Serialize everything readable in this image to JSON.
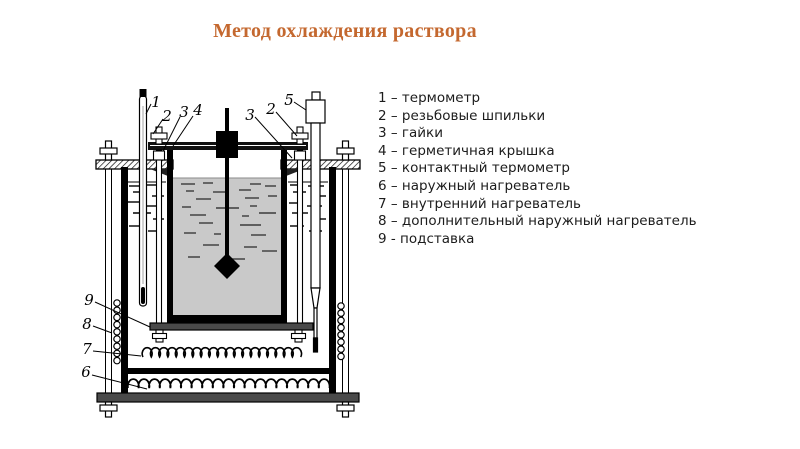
{
  "title": "Метод охлаждения раствора",
  "colors": {
    "title_accent": "#c4682f",
    "line": "#000000",
    "liquid": "#c9c9c9",
    "metal": "#4a4a4a"
  },
  "legend": {
    "items": [
      "1 – термометр",
      "2 – резьбовые шпильки",
      "3 – гайки",
      "4 – герметичная крышка",
      "5 – контактный термометр",
      "6 – наружный нагреватель",
      "7 – внутренний нагреватель",
      "8 – дополнительный наружный нагреватель",
      "9 - подставка"
    ]
  },
  "diagram": {
    "callouts": {
      "thermometer": "1",
      "stud_left": "2",
      "nuts_left": "3",
      "lid": "4",
      "nuts_right": "3",
      "stud_right": "2",
      "contact_thermometer": "5",
      "stand": "9",
      "extra_external_heater": "8",
      "internal_heater": "7",
      "external_heater": "6"
    }
  }
}
